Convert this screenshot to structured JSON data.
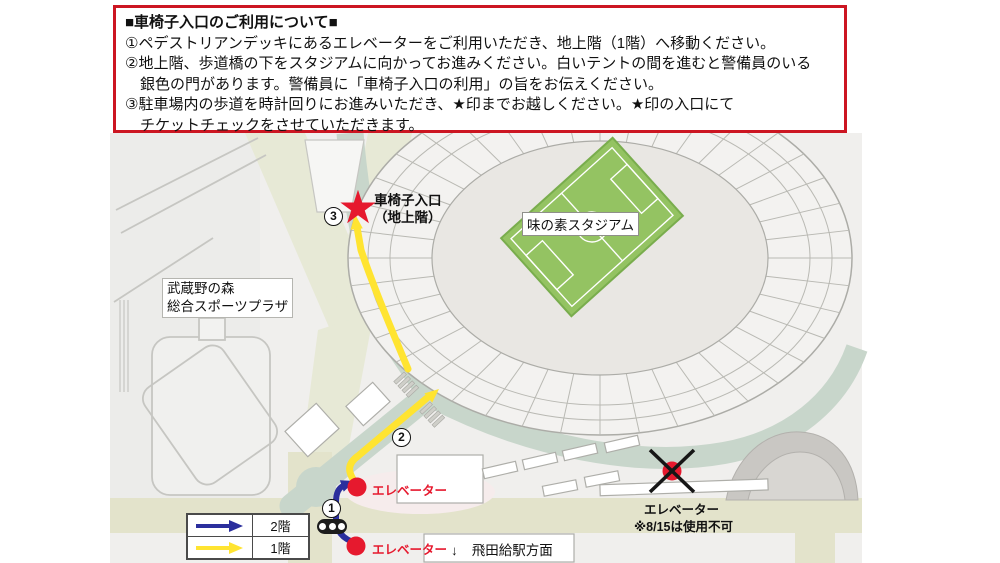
{
  "notice": {
    "title": "■車椅子入口のご利用について■",
    "lines": [
      "①ペデストリアンデッキにあるエレベーターをご利用いただき、地上階（1階）へ移動ください。",
      "②地上階、歩道橋の下をスタジアムに向かってお進みください。白いテントの間を進むと警備員のいる",
      "　銀色の門があります。警備員に「車椅子入口の利用」の旨をお伝えください。",
      "③駐車場内の歩道を時計回りにお進みいただき、★印までお越しください。★印の入口にて",
      "　チケットチェックをさせていただきます。"
    ]
  },
  "map": {
    "stadium_label": "味の素スタジアム",
    "plaza_label_line1": "武蔵野の森",
    "plaza_label_line2": "総合スポーツプラザ",
    "entrance_label_line1": "車椅子入口",
    "entrance_label_line2": "（地上階）",
    "star_glyph": "★",
    "elevator_upper_label": "エレベーター",
    "elevator_lower_label": "エレベーター",
    "elevator_closed_label": "エレベーター",
    "elevator_closed_note": "※8/15は使用不可",
    "station_arrow": "↓",
    "station_label": "飛田給駅方面",
    "marker1": "1",
    "marker2": "2",
    "marker3": "3"
  },
  "legend": {
    "floor2_label": "2階",
    "floor1_label": "1階"
  },
  "colors": {
    "notice_border": "#cc1622",
    "route_floor1": "#ffe431",
    "route_floor2": "#2b2f9d",
    "marker_red": "#e6192e",
    "road_green": "#c8d6cb",
    "road_beige": "#e3e3cb",
    "deck_olive": "#e7e9d6",
    "field_green": "#94c362"
  }
}
